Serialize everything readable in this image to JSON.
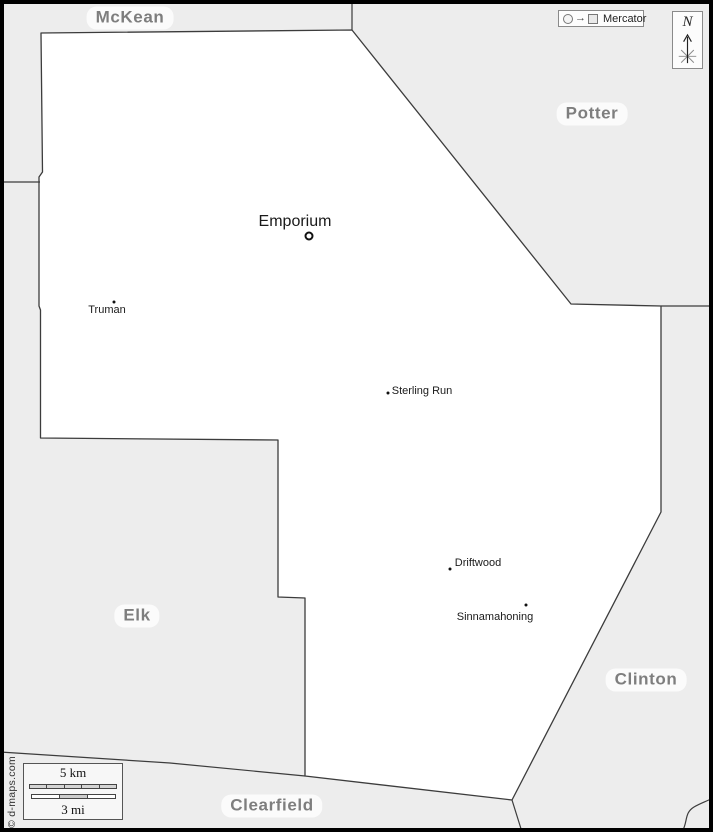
{
  "colors": {
    "background": "#ededed",
    "county_fill": "#ffffff",
    "boundary": "#3c3c3c",
    "frame": "#000000",
    "county_label_text": "#7e7e7e",
    "town_text": "#1a1a1a"
  },
  "neighbors": [
    {
      "label": "McKean"
    },
    {
      "label": "Potter"
    },
    {
      "label": "Elk"
    },
    {
      "label": "Clinton"
    },
    {
      "label": "Clearfield"
    }
  ],
  "towns": [
    {
      "label": "Emporium",
      "marker": "ring"
    },
    {
      "label": "Truman",
      "marker": "dot"
    },
    {
      "label": "Sterling Run",
      "marker": "dot"
    },
    {
      "label": "Driftwood",
      "marker": "dot"
    },
    {
      "label": "Sinnamahoning",
      "marker": "dot"
    }
  ],
  "legend": {
    "projection_label": "Mercator"
  },
  "compass": {
    "north_label": "N"
  },
  "scale_bar": {
    "metric_label": "5 km",
    "imperial_label": "3 mi"
  },
  "credit": "© d-maps.com"
}
